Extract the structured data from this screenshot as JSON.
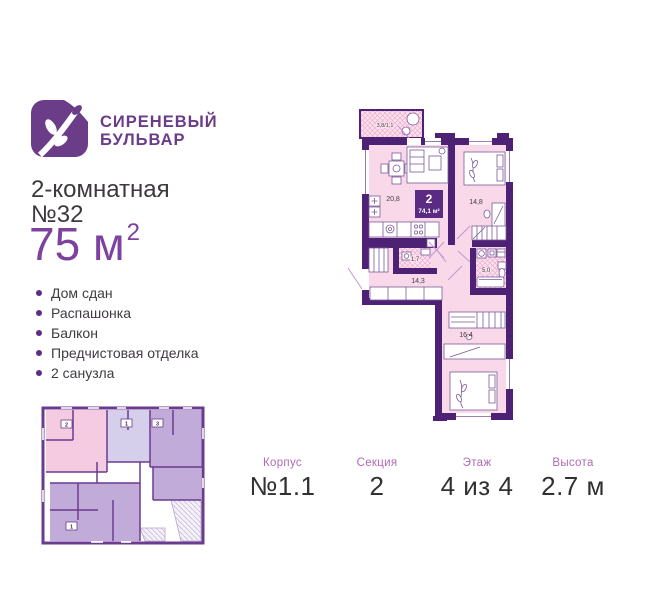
{
  "brand": {
    "line1": "СИРЕНЕВЫЙ",
    "line2": "БУЛЬВАР"
  },
  "listing": {
    "type_line": "2-комнатная",
    "number_line": "№32",
    "area": "75 м",
    "area_sup": "2",
    "features": [
      "Дом сдан",
      "Распашонка",
      "Балкон",
      "Предчистовая отделка",
      "2 санузла"
    ]
  },
  "floorplan": {
    "badge": {
      "rooms": "2",
      "area": "74,1 м²"
    },
    "labels": {
      "balcony": "3,8/1,1",
      "living": "20,8",
      "bedroom1": "14,8",
      "wc_small": "1,7",
      "hall": "14,3",
      "bathroom": "5,0",
      "bedroom2": "16,4"
    }
  },
  "overview": {
    "badges": [
      "2",
      "1",
      "3",
      "1"
    ]
  },
  "details": [
    {
      "label": "Корпус",
      "value": "№1.1"
    },
    {
      "label": "Секция",
      "value": "2"
    },
    {
      "label": "Этаж",
      "value": "4 из 4"
    },
    {
      "label": "Высота",
      "value": "2.7 м"
    }
  ],
  "colors": {
    "brand_purple": "#6b3d89",
    "accent_purple": "#7d419e",
    "wall_purple": "#4d2173",
    "room_pink": "#f8d8e9",
    "label_lilac": "#b16ab4",
    "text_dark": "#3a3a3a"
  }
}
